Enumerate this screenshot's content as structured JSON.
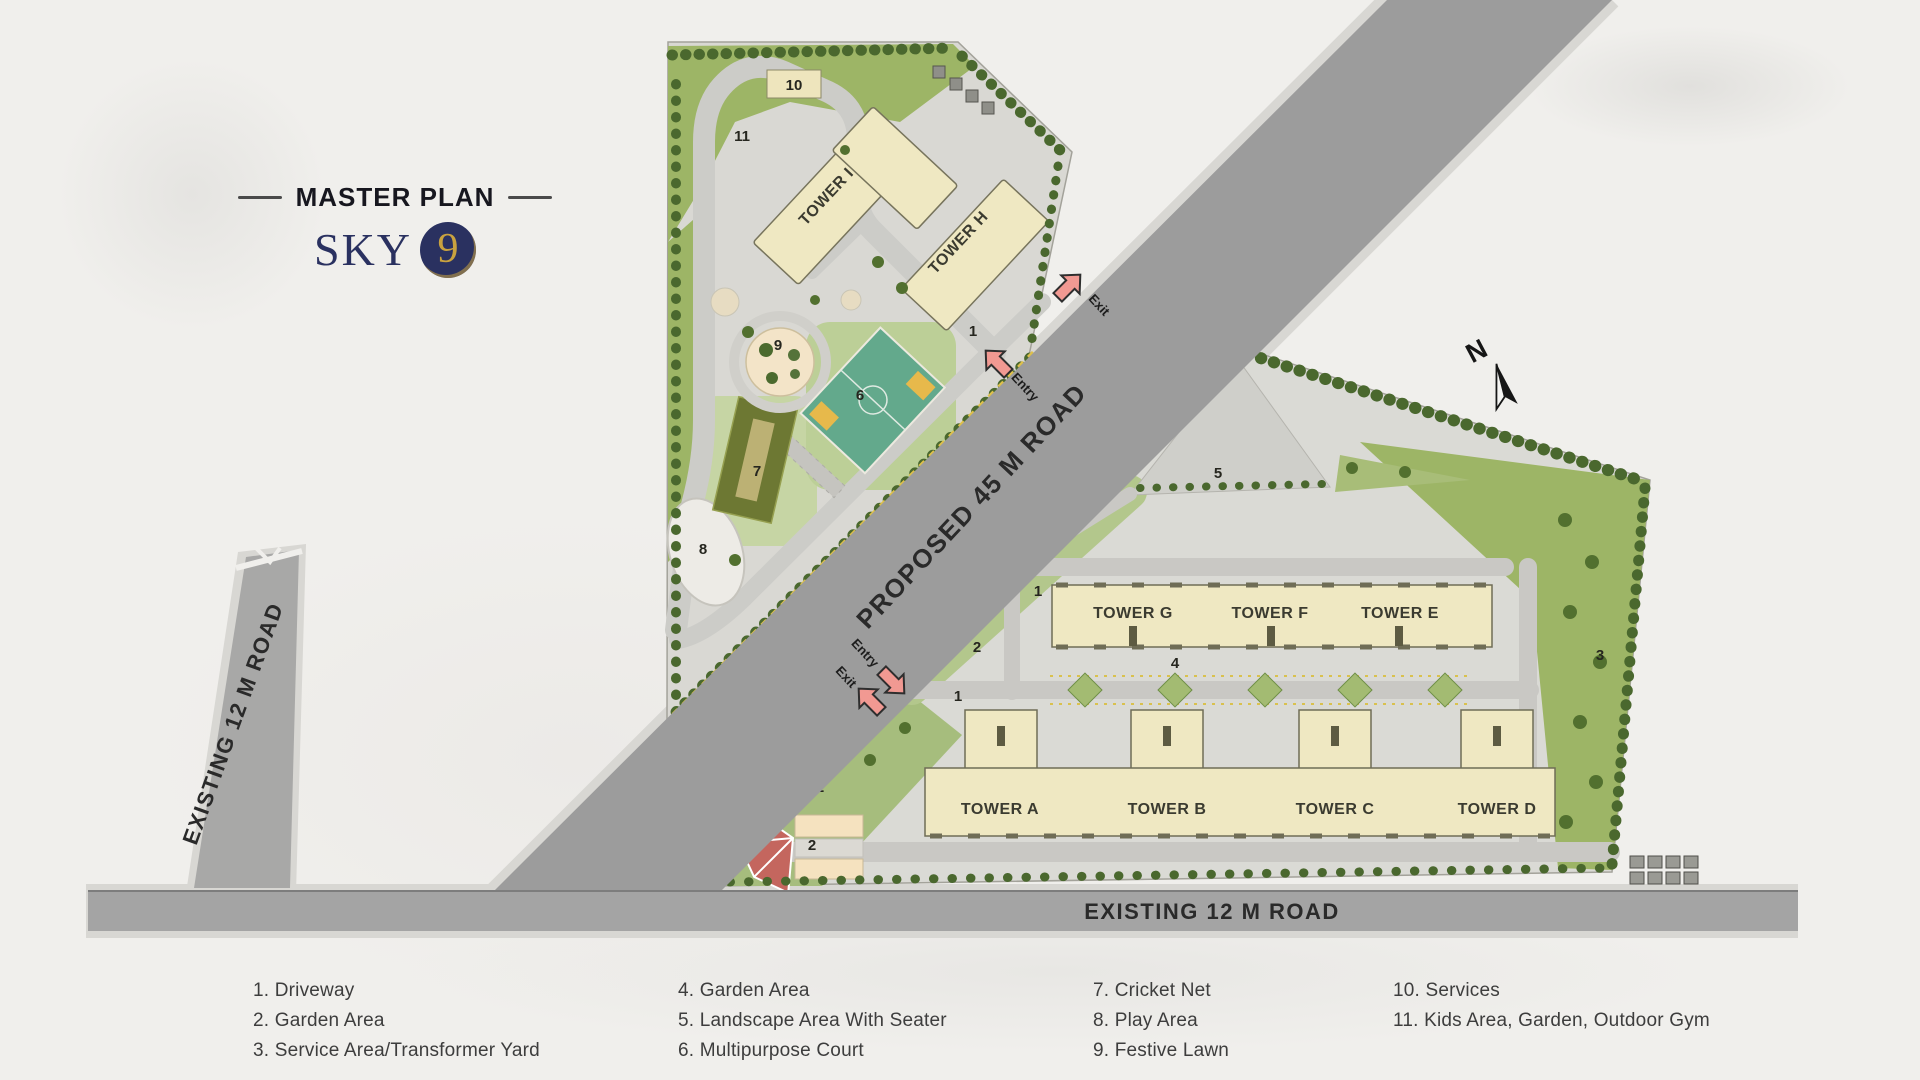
{
  "header": {
    "title": "MASTER PLAN",
    "logo_text": "SKY",
    "logo_number": "9"
  },
  "compass": {
    "label": "N"
  },
  "roads": {
    "proposed": {
      "label": "PROPOSED 45 M ROAD"
    },
    "existing_left": {
      "label": "EXISTING 12 M ROAD"
    },
    "existing_bottom": {
      "label": "EXISTING 12 M ROAD"
    }
  },
  "gates": {
    "entry": "Entry",
    "exit": "Exit"
  },
  "towers": {
    "upper": [
      {
        "label": "TOWER I"
      },
      {
        "label": "TOWER H"
      }
    ],
    "north_row": [
      {
        "label": "TOWER G"
      },
      {
        "label": "TOWER F"
      },
      {
        "label": "TOWER E"
      }
    ],
    "south_row": [
      {
        "label": "TOWER A"
      },
      {
        "label": "TOWER B"
      },
      {
        "label": "TOWER C"
      },
      {
        "label": "TOWER D"
      }
    ]
  },
  "plan": {
    "numbers": {
      "n1": "1",
      "n2": "2",
      "n3": "3",
      "n4": "4",
      "n5": "5",
      "n6": "6",
      "n7": "7",
      "n8": "8",
      "n9": "9",
      "n10": "10",
      "n11": "11"
    }
  },
  "legend": {
    "columns": [
      {
        "items": [
          "1. Driveway",
          "2. Garden Area",
          "3. Service Area/Transformer Yard"
        ]
      },
      {
        "items": [
          "4. Garden Area",
          "5. Landscape Area With Seater",
          "6. Multipurpose Court"
        ]
      },
      {
        "items": [
          "7. Cricket Net",
          "8. Play Area",
          "9. Festive Lawn"
        ]
      },
      {
        "items": [
          "10. Services",
          "11. Kids Area, Garden, Outdoor Gym"
        ]
      }
    ]
  },
  "colors": {
    "brand_navy": "#2a3160",
    "brand_gold": "#c9a23f",
    "road_gray": "#9c9c9c",
    "building_cream": "#efe8c2",
    "court_green": "#63a98c",
    "arrow_pink": "#f19992",
    "garden_green": "#9db566"
  }
}
